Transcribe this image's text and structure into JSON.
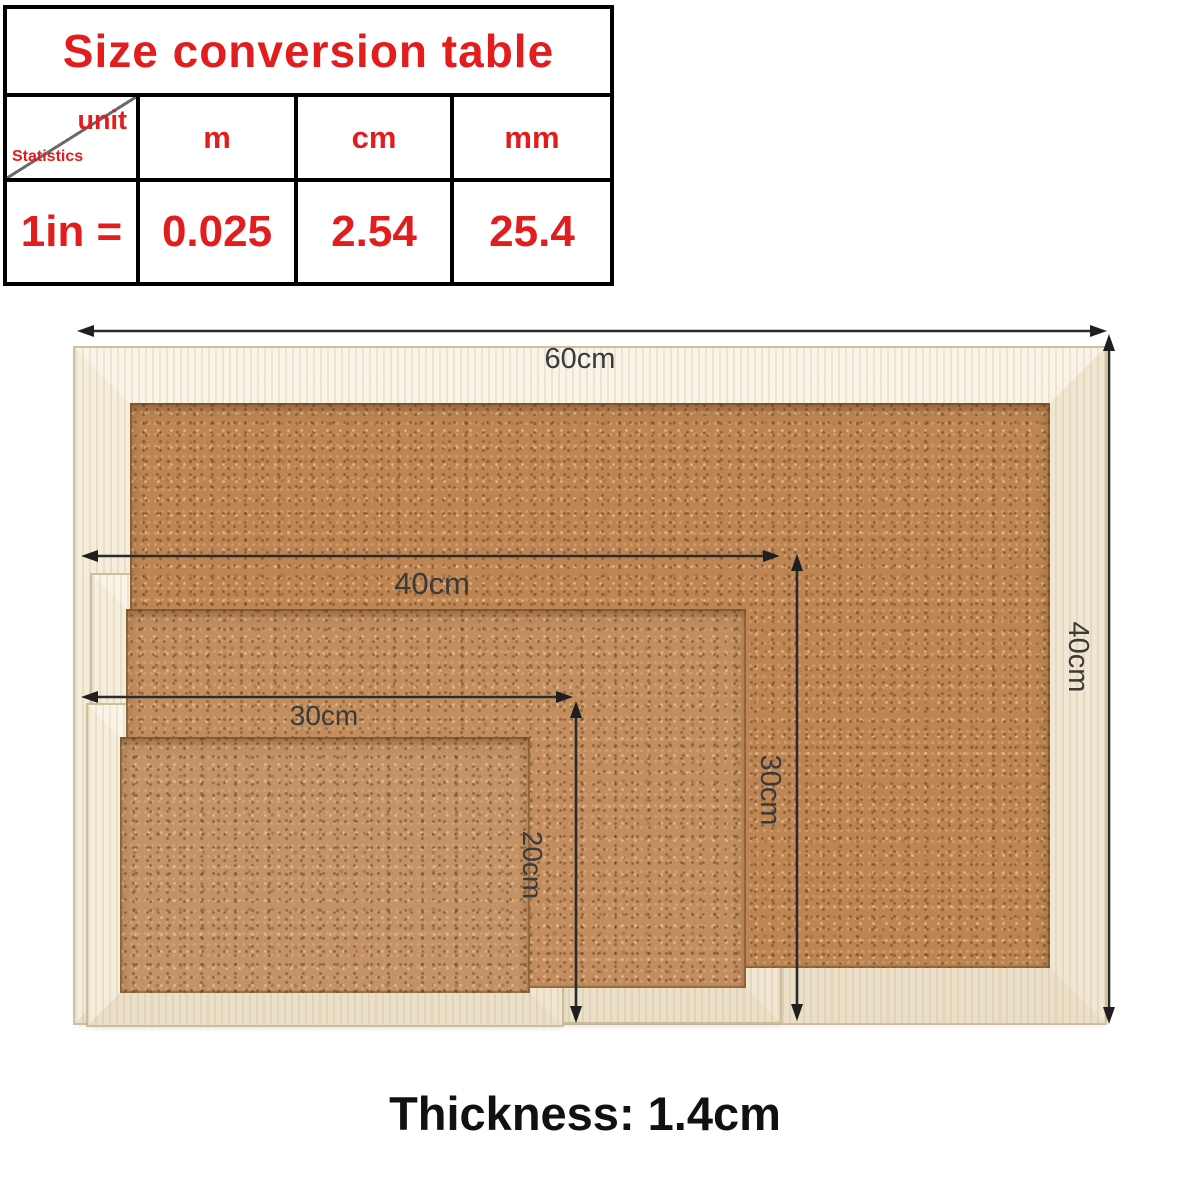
{
  "conversion_table": {
    "title": "Size conversion table",
    "corner": {
      "unit_label": "unit",
      "statistics_label": "Statistics"
    },
    "column_headers": [
      "m",
      "cm",
      "mm"
    ],
    "row": {
      "label": "1in =",
      "values": [
        "0.025",
        "2.54",
        "25.4"
      ]
    }
  },
  "boards": {
    "large": {
      "width_label": "60cm",
      "height_label": "40cm"
    },
    "medium": {
      "width_label": "40cm",
      "height_label": "30cm"
    },
    "small": {
      "width_label": "30cm",
      "height_label": "20cm"
    }
  },
  "footer": {
    "thickness_label": "Thickness: 1.4cm"
  },
  "colors": {
    "accent_red": "#e21d1d",
    "arrow": "#2b2b2b",
    "wood_frame": "#f6efdf",
    "cork": "#c08a5e"
  }
}
